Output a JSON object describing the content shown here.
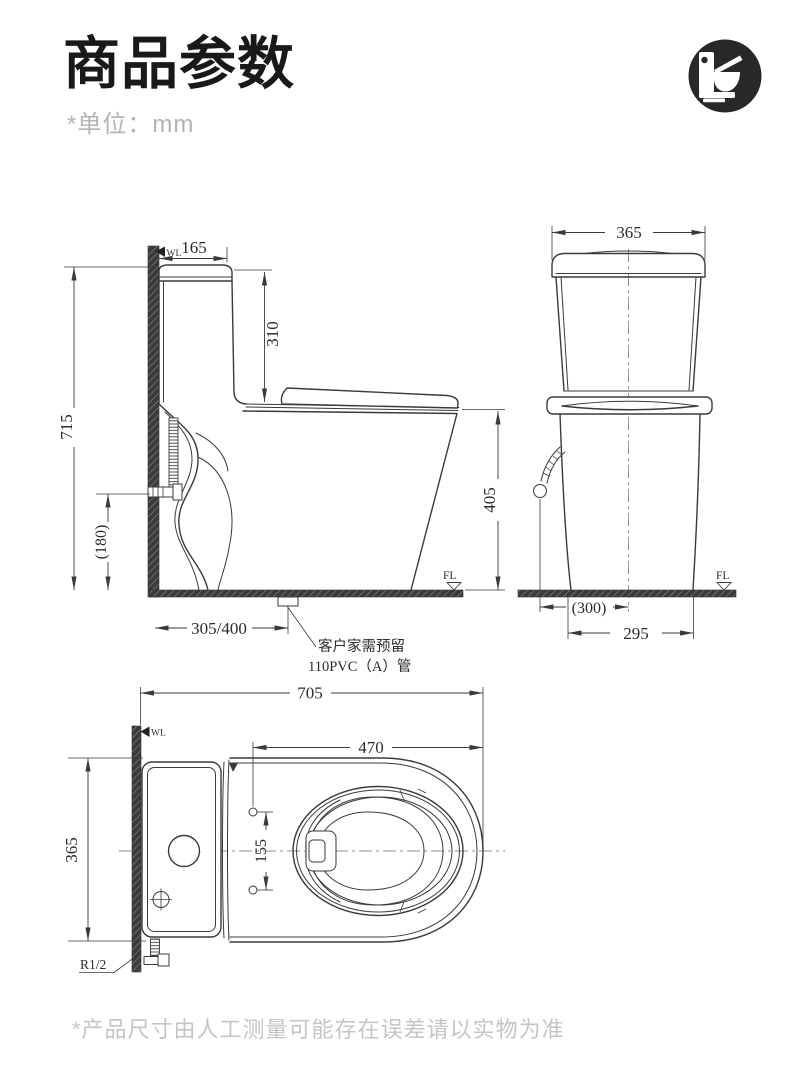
{
  "header": {
    "title": "商品参数",
    "unit_note": "*单位：mm",
    "icon": "toilet-icon",
    "icon_bg": "#282828"
  },
  "views": {
    "side": {
      "dims": {
        "tank_depth": "165",
        "tank_to_seat": "310",
        "total_height": "715",
        "inlet_height": "(180)",
        "bowl_height": "405",
        "rough_in": "305/400"
      },
      "wall_line_label": "WL",
      "floor_line_label": "FL",
      "drain_note": [
        "客户家需预留",
        "110PVC（A）管"
      ]
    },
    "front": {
      "dims": {
        "tank_width": "365",
        "inlet_offset": "(300)",
        "base_width": "295"
      },
      "floor_line_label": "FL"
    },
    "top": {
      "dims": {
        "total_depth": "705",
        "seat_length": "470",
        "body_width": "365",
        "hinge_hole_spacing": "155",
        "inlet_thread": "R1/2"
      },
      "wall_line_label": "WL"
    }
  },
  "footer": {
    "disclaimer": "*产品尺寸由人工测量可能存在误差请以实物为准"
  }
}
